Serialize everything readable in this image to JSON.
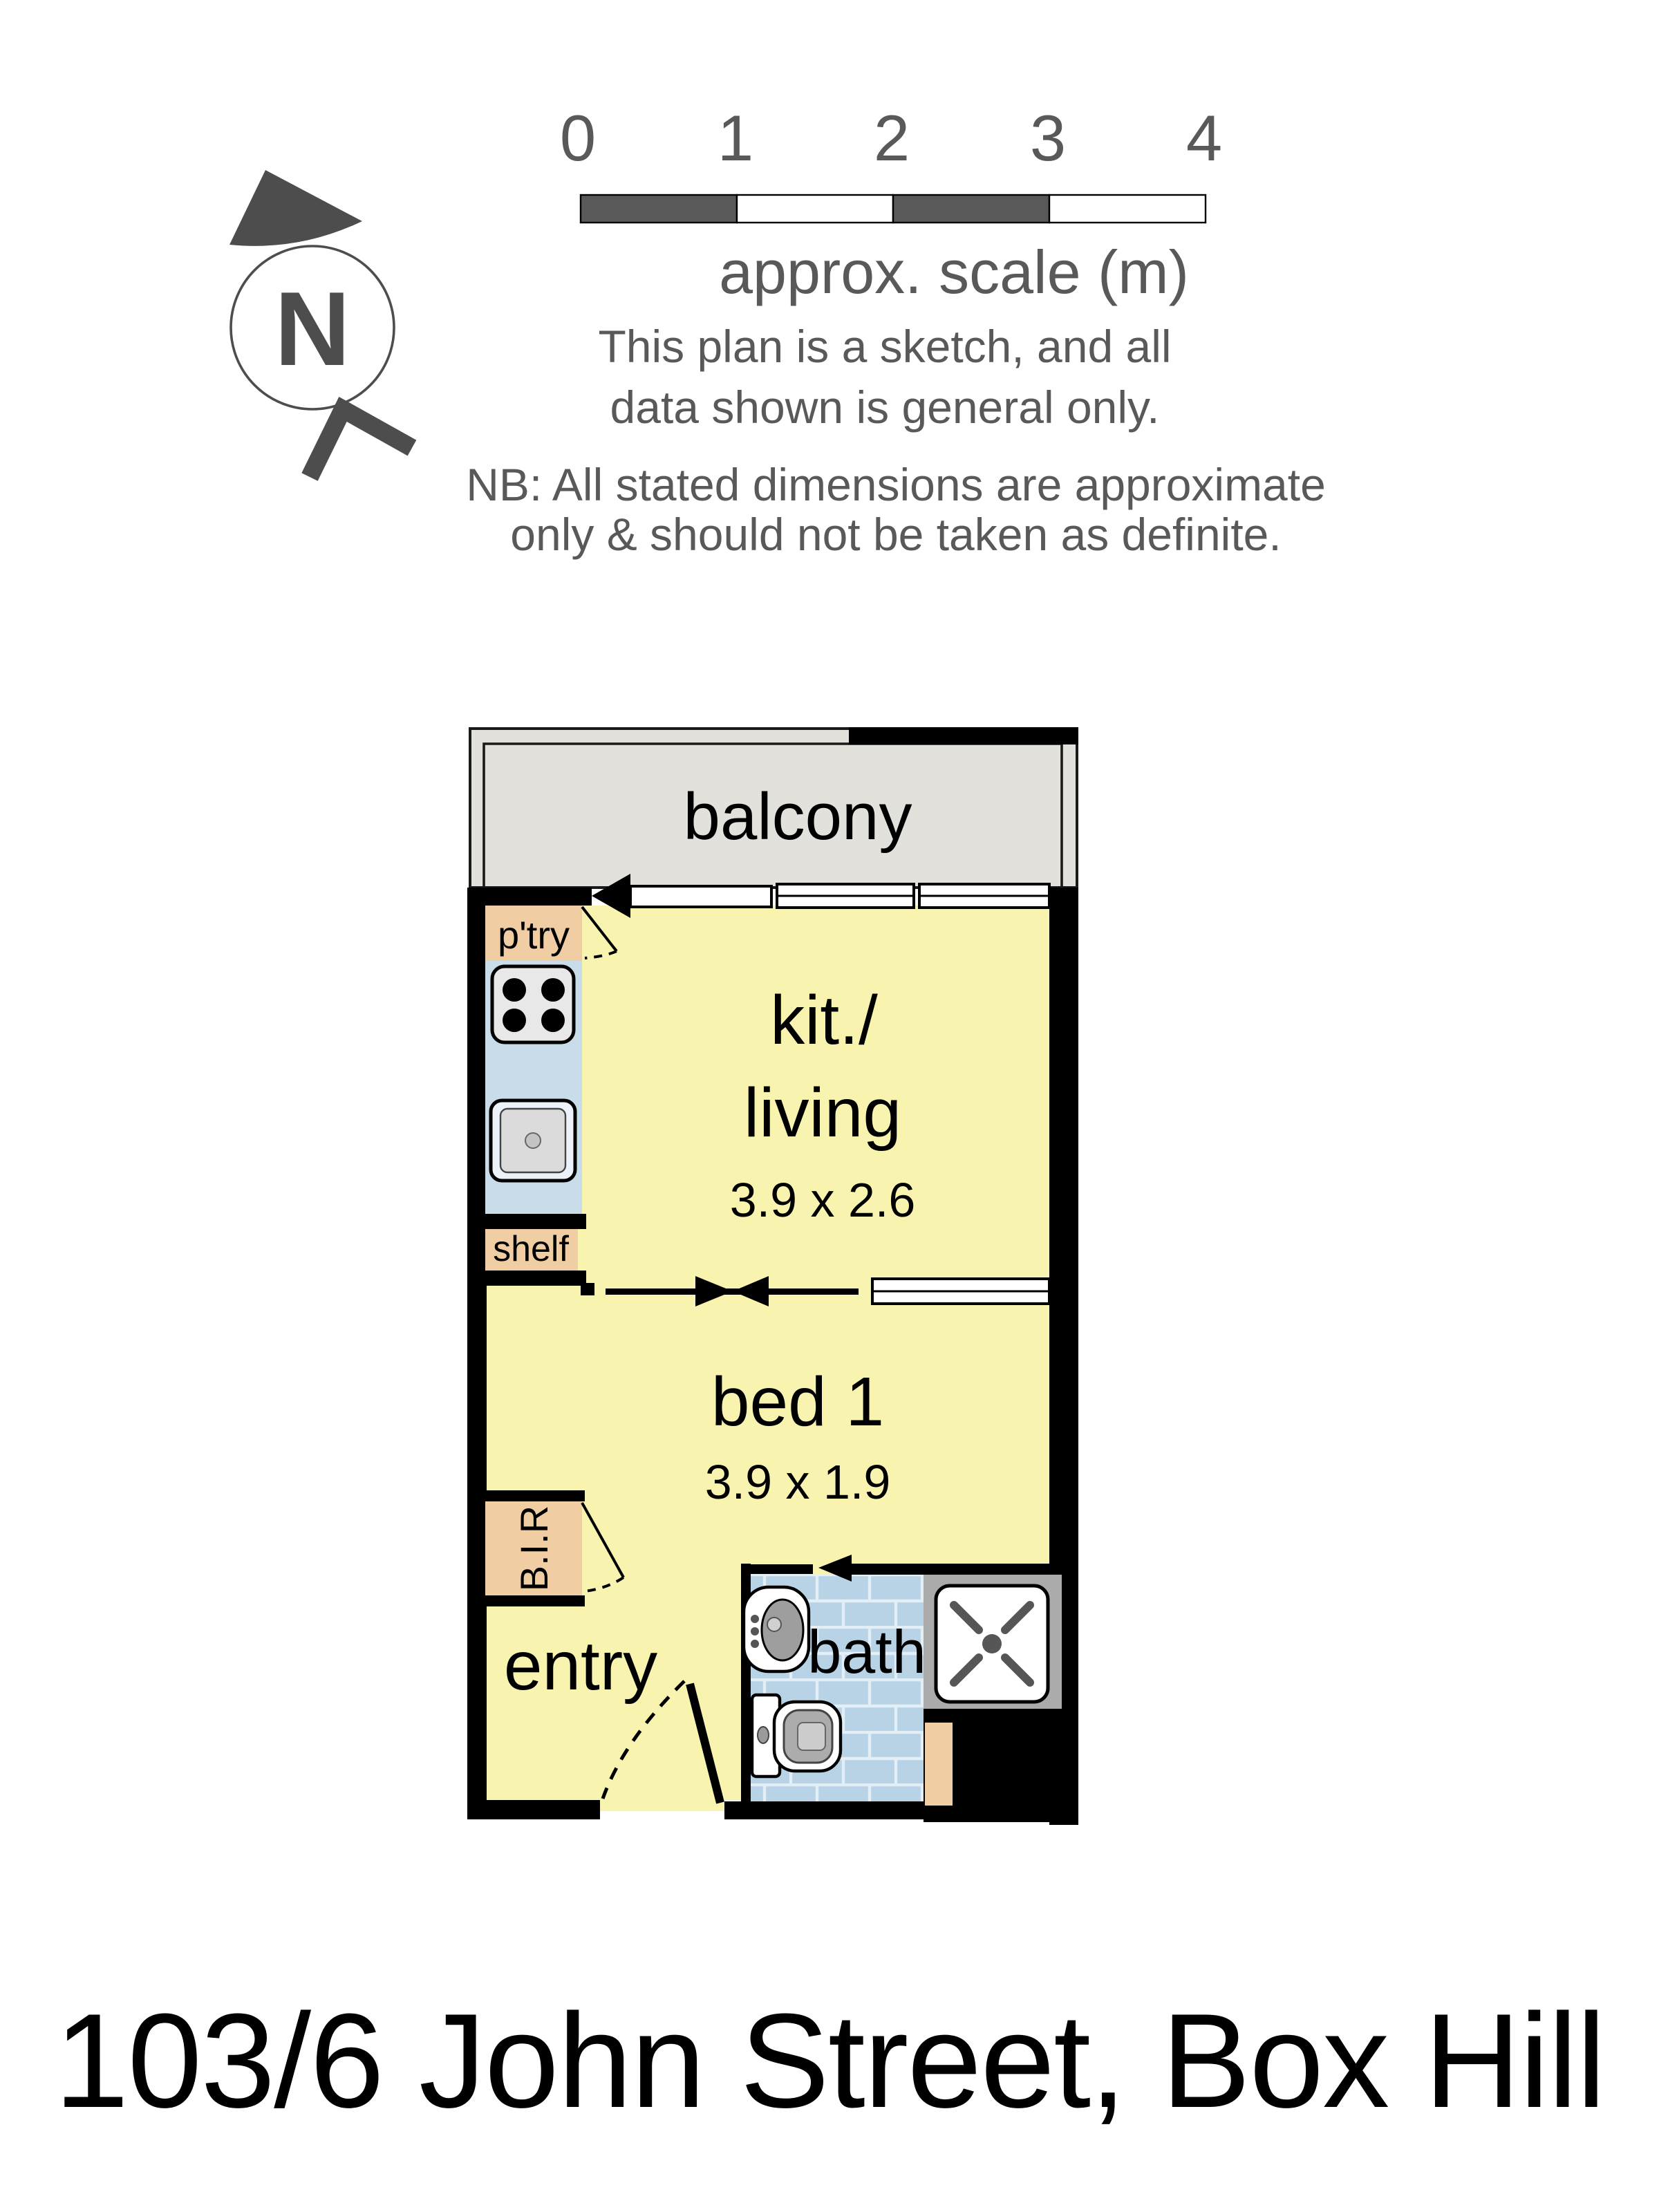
{
  "title": "103/6 John Street, Box Hill",
  "compass": {
    "label": "N"
  },
  "scale_bar": {
    "ticks": [
      "0",
      "1",
      "2",
      "3",
      "4"
    ],
    "caption": "approx. scale (m)"
  },
  "disclaimer": {
    "line1": "This plan is a sketch, and all",
    "line2": "data shown is general only.",
    "note1": "NB: All stated dimensions are approximate",
    "note2": "only & should not be taken as definite."
  },
  "plan": {
    "balcony": {
      "label": "balcony"
    },
    "kitchen_living": {
      "label_line1": "kit./",
      "label_line2": "living",
      "dimensions": "3.9 x 2.6"
    },
    "bed1": {
      "label": "bed 1",
      "dimensions": "3.9 x 1.9"
    },
    "entry": {
      "label": "entry"
    },
    "bath": {
      "label": "bath"
    },
    "pantry": {
      "label": "p'try"
    },
    "shelf": {
      "label": "shelf"
    },
    "built_in_robe": {
      "label": "B.I.R"
    }
  },
  "colors": {
    "wall": "#000000",
    "floor_yellow": "#F8F4AF",
    "balcony_gray": "#E2E1DC",
    "cabinet_tan": "#F1CDA3",
    "counter_blue": "#C8DCEA",
    "bath_tile_blue": "#B9D3E6",
    "shower_gray": "#ABABAB",
    "annotation_gray": "#595959"
  }
}
